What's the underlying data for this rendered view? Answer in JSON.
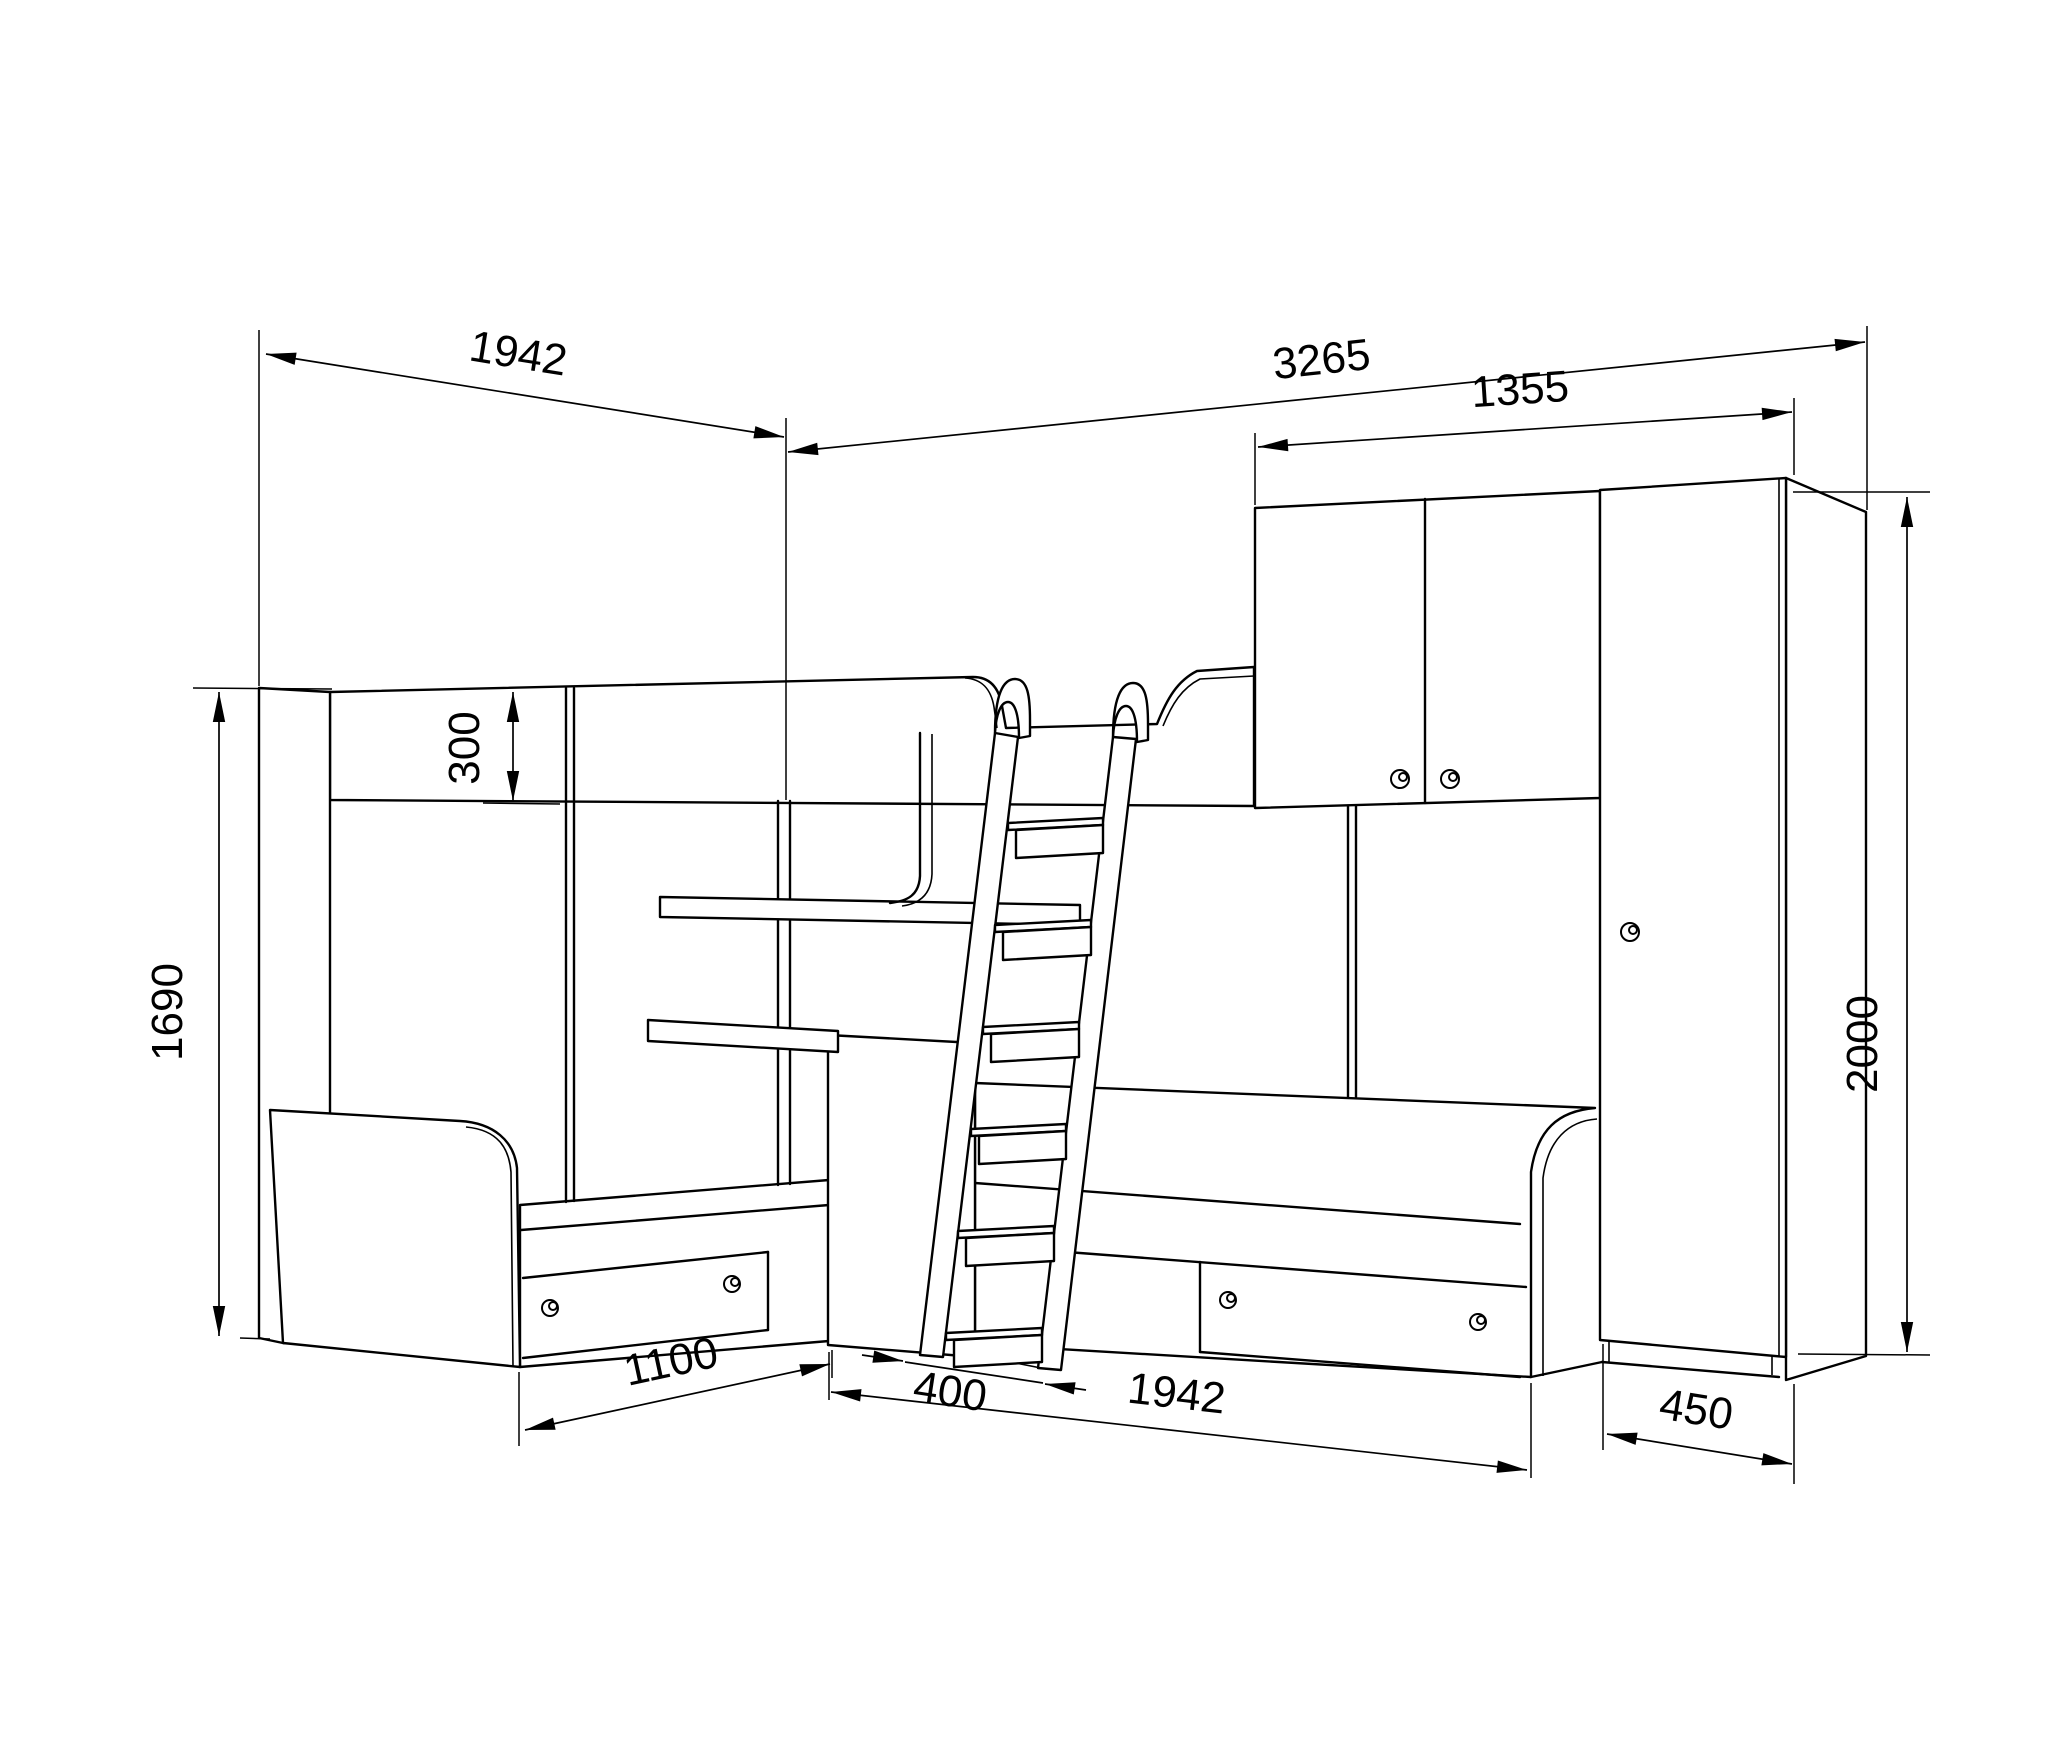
{
  "drawing": {
    "kind": "furniture dimensional line drawing (corner bunk-bed set with desk, ladder, overhead cabinet and wardrobe)",
    "units_implied": "mm",
    "line_color": "#000000",
    "background": "#ffffff"
  },
  "dimensions": {
    "left_bed_length": {
      "value": "1942",
      "orientation": "horizontal-top-left"
    },
    "overall_width": {
      "value": "3265",
      "orientation": "horizontal-top"
    },
    "cabinet_width": {
      "value": "1355",
      "orientation": "horizontal-top-right"
    },
    "rail_height": {
      "value": "300",
      "orientation": "vertical-center-left"
    },
    "panel_height": {
      "value": "1690",
      "orientation": "vertical-far-left"
    },
    "wardrobe_height": {
      "value": "2000",
      "orientation": "vertical-far-right"
    },
    "left_bed_front": {
      "value": "1100",
      "orientation": "horizontal-bottom-left"
    },
    "ladder_depth": {
      "value": "400",
      "orientation": "horizontal-bottom-center"
    },
    "right_bed_length": {
      "value": "1942",
      "orientation": "horizontal-bottom"
    },
    "wardrobe_depth": {
      "value": "450",
      "orientation": "horizontal-bottom-right"
    }
  }
}
